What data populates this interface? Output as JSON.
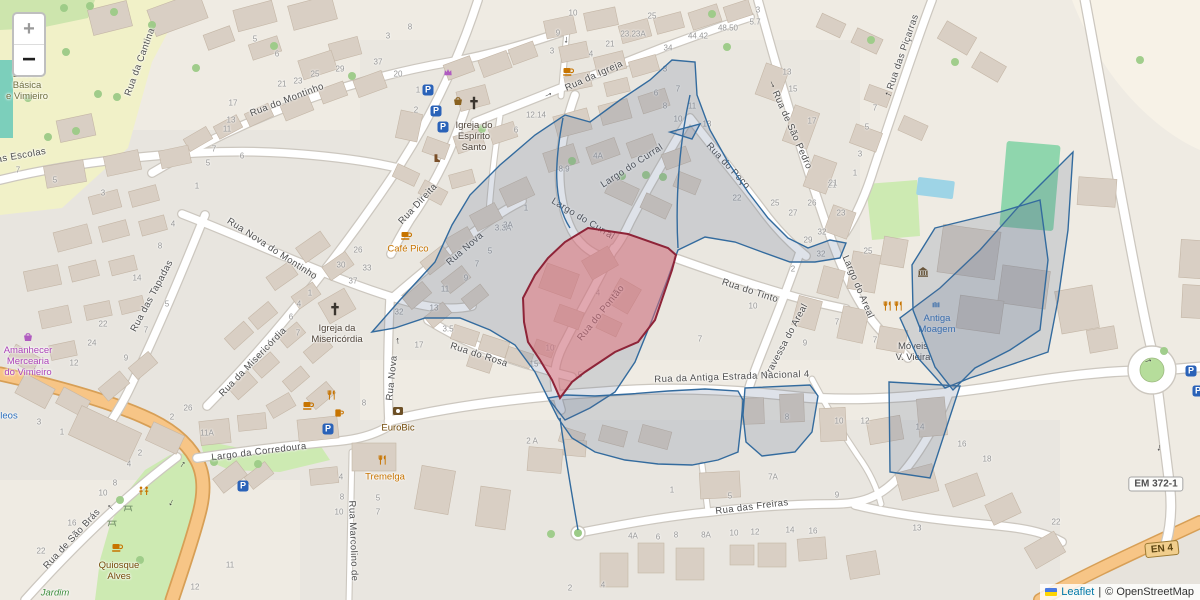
{
  "controls": {
    "zoom_in": "+",
    "zoom_out": "−"
  },
  "attribution": {
    "leaflet": "Leaflet",
    "separator": "|",
    "osm": "© OpenStreetMap"
  },
  "shields": [
    {
      "label": "EM 372-1",
      "x": 1156,
      "y": 484,
      "style": "white",
      "rot": 0
    },
    {
      "label": "EN 4",
      "x": 1162,
      "y": 549,
      "style": "tan",
      "rot": -6
    }
  ],
  "street_labels": [
    [
      140,
      62,
      -70,
      "Rua da Cantina"
    ],
    [
      8,
      158,
      -10,
      "Rua das Escolas"
    ],
    [
      287,
      100,
      -21,
      "Rua do Montinho"
    ],
    [
      272,
      249,
      33,
      "Rua Nova do Montinho"
    ],
    [
      253,
      362,
      -46,
      "Rua da Misericórdia"
    ],
    [
      152,
      296,
      -62,
      "Rua das Tapadas"
    ],
    [
      72,
      539,
      -47,
      "Rua de São Brás"
    ],
    [
      259,
      452,
      -7,
      "Largo da Corredoura"
    ],
    [
      418,
      204,
      -47,
      "Rua Direita"
    ],
    [
      465,
      249,
      -41,
      "Rua Nova"
    ],
    [
      392,
      378,
      -84,
      "Rua Nova"
    ],
    [
      594,
      76,
      -24,
      "Rua da Igreja"
    ],
    [
      632,
      166,
      -33,
      "Largo do Curral"
    ],
    [
      583,
      219,
      31,
      "Largo do Curral"
    ],
    [
      728,
      166,
      47,
      "Rua do Poço"
    ],
    [
      792,
      130,
      66,
      "Rua de São Pedro"
    ],
    [
      903,
      52,
      -71,
      "Rua das Piçarras"
    ],
    [
      858,
      287,
      67,
      "Largo do Areal"
    ],
    [
      786,
      341,
      -62,
      "Travessa do Areal"
    ],
    [
      750,
      291,
      18,
      "Rua do Tinto"
    ],
    [
      601,
      313,
      -51,
      "Rua do Pontão"
    ],
    [
      479,
      355,
      18,
      "Rua do Rosa"
    ],
    [
      732,
      377,
      -2,
      "Rua da Antiga Estrada Nacional 4"
    ],
    [
      752,
      507,
      -7,
      "Rua das Freiras"
    ],
    [
      353,
      541,
      88,
      "Rua Marcolino de"
    ]
  ],
  "poi_labels": [
    {
      "lines": [
        "Escola",
        "Básica",
        "e Vimieiro"
      ],
      "x": 27,
      "y": 86,
      "color": "#6e6e3e",
      "italic": false
    },
    {
      "lines": [
        "Igreja do",
        "Espírito",
        "Santo"
      ],
      "x": 474,
      "y": 137,
      "color": "#4e4338",
      "italic": false
    },
    {
      "lines": [
        "Igreja da",
        "Misericórdia"
      ],
      "x": 337,
      "y": 334,
      "color": "#4e4338",
      "italic": false
    },
    {
      "lines": [
        "Café Pico"
      ],
      "x": 408,
      "y": 249,
      "color": "#c77400",
      "italic": false
    },
    {
      "lines": [
        "EuroBic"
      ],
      "x": 398,
      "y": 428,
      "color": "#734a08",
      "italic": false
    },
    {
      "lines": [
        "Tremelga"
      ],
      "x": 385,
      "y": 477,
      "color": "#c77400",
      "italic": false
    },
    {
      "lines": [
        "Antiga",
        "Moagem"
      ],
      "x": 937,
      "y": 324,
      "color": "#2a6ebb",
      "italic": false
    },
    {
      "lines": [
        "Móveis",
        "V. Vieira"
      ],
      "x": 913,
      "y": 352,
      "color": "#4a4a4a",
      "italic": false
    },
    {
      "lines": [
        "Amanhecer",
        "Mercearia",
        "do Vimieiro"
      ],
      "x": 28,
      "y": 362,
      "color": "#ab44b8",
      "italic": false
    },
    {
      "lines": [
        "Quiosque",
        "Alves"
      ],
      "x": 119,
      "y": 571,
      "color": "#734a08",
      "italic": false
    },
    {
      "lines": [
        "Jardim"
      ],
      "x": 55,
      "y": 593,
      "color": "#3e8e3e",
      "italic": true
    },
    {
      "lines": [
        "leos"
      ],
      "x": 9,
      "y": 416,
      "color": "#2a6ebb",
      "italic": false
    }
  ],
  "house_numbers": [
    [
      573,
      13,
      "10"
    ],
    [
      652,
      16,
      "25"
    ],
    [
      633,
      34,
      "23.23A"
    ],
    [
      610,
      44,
      "21"
    ],
    [
      698,
      36,
      "44.42"
    ],
    [
      728,
      28,
      "48.50"
    ],
    [
      668,
      48,
      "34"
    ],
    [
      755,
      22,
      "5.7"
    ],
    [
      758,
      10,
      "3"
    ],
    [
      558,
      33,
      "9"
    ],
    [
      552,
      51,
      "3"
    ],
    [
      591,
      54,
      "4"
    ],
    [
      398,
      74,
      "20"
    ],
    [
      418,
      90,
      "1"
    ],
    [
      416,
      110,
      "2"
    ],
    [
      536,
      115,
      "12.14"
    ],
    [
      516,
      130,
      "6"
    ],
    [
      598,
      156,
      "4A"
    ],
    [
      564,
      169,
      "8.9"
    ],
    [
      255,
      39,
      "5"
    ],
    [
      277,
      54,
      "6"
    ],
    [
      282,
      84,
      "21"
    ],
    [
      298,
      81,
      "23"
    ],
    [
      315,
      74,
      "25"
    ],
    [
      340,
      69,
      "29"
    ],
    [
      378,
      62,
      "37"
    ],
    [
      410,
      27,
      "8"
    ],
    [
      388,
      36,
      "3"
    ],
    [
      233,
      103,
      "17"
    ],
    [
      231,
      120,
      "13"
    ],
    [
      227,
      129,
      "11"
    ],
    [
      214,
      149,
      "7"
    ],
    [
      242,
      156,
      "6"
    ],
    [
      208,
      163,
      "5"
    ],
    [
      18,
      170,
      "7"
    ],
    [
      55,
      180,
      "5"
    ],
    [
      103,
      193,
      "3"
    ],
    [
      197,
      186,
      "1"
    ],
    [
      173,
      224,
      "4"
    ],
    [
      160,
      246,
      "8"
    ],
    [
      137,
      278,
      "14"
    ],
    [
      167,
      304,
      "5"
    ],
    [
      103,
      324,
      "22"
    ],
    [
      358,
      250,
      "26"
    ],
    [
      341,
      265,
      "30"
    ],
    [
      367,
      268,
      "33"
    ],
    [
      353,
      281,
      "37"
    ],
    [
      310,
      293,
      "1"
    ],
    [
      299,
      304,
      "4"
    ],
    [
      291,
      317,
      "6"
    ],
    [
      298,
      333,
      "7"
    ],
    [
      399,
      312,
      "32"
    ],
    [
      419,
      345,
      "17"
    ],
    [
      503,
      228,
      "3.3A"
    ],
    [
      490,
      251,
      "5"
    ],
    [
      477,
      264,
      "7"
    ],
    [
      466,
      278,
      "9"
    ],
    [
      445,
      289,
      "11"
    ],
    [
      434,
      308,
      "13"
    ],
    [
      448,
      329,
      "3.5"
    ],
    [
      550,
      348,
      "10"
    ],
    [
      534,
      364,
      "15"
    ],
    [
      580,
      375,
      "5"
    ],
    [
      526,
      208,
      "1"
    ],
    [
      508,
      225,
      "3A"
    ],
    [
      737,
      198,
      "22"
    ],
    [
      775,
      203,
      "25"
    ],
    [
      793,
      213,
      "27"
    ],
    [
      793,
      269,
      "2"
    ],
    [
      753,
      306,
      "10"
    ],
    [
      598,
      293,
      "4"
    ],
    [
      700,
      339,
      "7"
    ],
    [
      832,
      185,
      "21"
    ],
    [
      812,
      203,
      "26"
    ],
    [
      841,
      213,
      "23"
    ],
    [
      822,
      232,
      "32"
    ],
    [
      808,
      240,
      "29"
    ],
    [
      821,
      254,
      "32"
    ],
    [
      868,
      251,
      "25"
    ],
    [
      805,
      343,
      "9"
    ],
    [
      837,
      322,
      "7"
    ],
    [
      787,
      72,
      "13"
    ],
    [
      793,
      89,
      "15"
    ],
    [
      812,
      121,
      "17"
    ],
    [
      833,
      183,
      "21"
    ],
    [
      860,
      154,
      "3"
    ],
    [
      855,
      173,
      "1"
    ],
    [
      867,
      127,
      "5"
    ],
    [
      875,
      108,
      "7"
    ],
    [
      665,
      69,
      "3"
    ],
    [
      656,
      93,
      "6"
    ],
    [
      678,
      89,
      "7"
    ],
    [
      665,
      106,
      "8"
    ],
    [
      692,
      106,
      "11"
    ],
    [
      678,
      119,
      "10"
    ],
    [
      707,
      124,
      "13"
    ],
    [
      875,
      340,
      "7"
    ],
    [
      532,
      441,
      "2 A"
    ],
    [
      364,
      403,
      "8"
    ],
    [
      341,
      477,
      "4"
    ],
    [
      342,
      497,
      "8"
    ],
    [
      339,
      512,
      "10"
    ],
    [
      378,
      498,
      "5"
    ],
    [
      378,
      512,
      "7"
    ],
    [
      140,
      453,
      "2"
    ],
    [
      129,
      464,
      "4"
    ],
    [
      115,
      483,
      "8"
    ],
    [
      103,
      493,
      "10"
    ],
    [
      72,
      523,
      "16"
    ],
    [
      41,
      551,
      "22"
    ],
    [
      230,
      565,
      "11"
    ],
    [
      195,
      587,
      "12"
    ],
    [
      672,
      490,
      "1"
    ],
    [
      730,
      496,
      "5"
    ],
    [
      837,
      495,
      "9"
    ],
    [
      633,
      536,
      "4A"
    ],
    [
      658,
      537,
      "6"
    ],
    [
      676,
      535,
      "8"
    ],
    [
      706,
      535,
      "8A"
    ],
    [
      734,
      533,
      "10"
    ],
    [
      755,
      532,
      "12"
    ],
    [
      790,
      530,
      "14"
    ],
    [
      813,
      531,
      "16"
    ],
    [
      570,
      588,
      "2"
    ],
    [
      603,
      585,
      "4"
    ],
    [
      787,
      417,
      "8"
    ],
    [
      839,
      421,
      "10"
    ],
    [
      865,
      421,
      "12"
    ],
    [
      920,
      427,
      "14"
    ],
    [
      962,
      444,
      "16"
    ],
    [
      987,
      459,
      "18"
    ],
    [
      773,
      477,
      "7A"
    ],
    [
      917,
      528,
      "13"
    ],
    [
      1056,
      522,
      "22"
    ],
    [
      92,
      343,
      "24"
    ],
    [
      74,
      363,
      "12"
    ],
    [
      126,
      358,
      "9"
    ],
    [
      146,
      330,
      "7"
    ],
    [
      39,
      422,
      "3"
    ],
    [
      62,
      432,
      "1"
    ],
    [
      172,
      417,
      "2"
    ],
    [
      188,
      408,
      "26"
    ],
    [
      207,
      433,
      "11A"
    ]
  ],
  "parking": {
    "glyph": "P",
    "positions": [
      [
        428,
        90
      ],
      [
        436,
        111
      ],
      [
        443,
        127
      ],
      [
        328,
        429
      ],
      [
        243,
        486
      ],
      [
        1191,
        371
      ],
      [
        1198,
        391
      ]
    ]
  },
  "icons": [
    [
      "church",
      474,
      103
    ],
    [
      "church",
      335,
      309
    ],
    [
      "cafe",
      568,
      71
    ],
    [
      "cafe",
      406,
      235
    ],
    [
      "cafe",
      308,
      405
    ],
    [
      "cafe",
      117,
      547
    ],
    [
      "restaurant",
      332,
      395
    ],
    [
      "restaurant",
      383,
      460
    ],
    [
      "restaurant",
      888,
      306
    ],
    [
      "restaurant",
      899,
      306
    ],
    [
      "bar",
      339,
      413
    ],
    [
      "museum",
      923,
      272
    ],
    [
      "bank",
      398,
      411
    ],
    [
      "shop",
      28,
      337
    ],
    [
      "crown",
      448,
      72
    ],
    [
      "basket",
      458,
      101
    ],
    [
      "boot",
      437,
      158
    ],
    [
      "mill",
      936,
      305
    ],
    [
      "playground",
      144,
      491
    ],
    [
      "picnic",
      128,
      508
    ],
    [
      "picnic",
      112,
      523
    ]
  ],
  "icon_colors": {
    "church": "#3a352f",
    "cafe": "#c77400",
    "restaurant": "#c77400",
    "bar": "#c77400",
    "museum": "#6d5026",
    "bank": "#6d5026",
    "shop": "#b05bc0",
    "crown": "#b05bc0",
    "basket": "#8a6220",
    "boot": "#7a4f28",
    "mill": "#2a6ebb",
    "playground": "#c77400",
    "picnic": "#7c9970"
  },
  "oneway": {
    "glyph": "→",
    "positions": [
      [
        548,
        94,
        -25
      ],
      [
        567,
        40,
        95
      ],
      [
        397,
        341,
        -95
      ],
      [
        773,
        84,
        65
      ],
      [
        888,
        95,
        205
      ],
      [
        110,
        508,
        -135
      ],
      [
        182,
        464,
        -55
      ],
      [
        172,
        503,
        115
      ],
      [
        1148,
        360,
        -15
      ],
      [
        1160,
        448,
        100
      ]
    ]
  },
  "overlays": {
    "blue_stroke": "#336b9e",
    "blue_fill": "rgba(90,110,145,0.20)",
    "blue_polys": [
      "372,332 400,300 435,262 452,225 470,195 500,165 535,135 565,115 590,122 620,100 650,80 672,60 695,62 697,95 710,130 728,162 748,192 768,218 788,238 808,248 830,240 846,243 840,258 815,262 790,262 762,252 735,242 705,237 678,250 668,278 652,320 635,362 615,392 590,408 565,420 548,398 535,372 515,345 490,330 460,318 425,318 395,328",
      "548,398 558,418 572,438 595,452 625,460 658,464 692,465 718,460 738,452 741,425 743,400 738,391 705,389 668,391 630,394 595,396 566,395",
      "745,388 810,385 818,396 812,432 795,452 762,456 746,442 743,415",
      "889,382 960,386 930,478 890,472",
      "1073,152 1068,230 1058,300 1048,352 1010,365 970,378 945,388 918,358 900,318 940,288 980,250 1020,205 1050,175",
      "935,228 1000,212 1040,200 1048,260 1040,330 1010,350 975,368 953,390 935,367 913,310 912,265",
      "670,132 700,124 692,139"
    ],
    "blue_lines": [
      "M563,118 C555,160 552,200 570,228",
      "M690,95 C680,140 675,195 678,248",
      "M560,418 C565,455 572,495 578,530"
    ],
    "red": {
      "stroke": "#8e2438",
      "fill": "rgba(228,110,120,0.5)",
      "points": "588,228 628,234 668,248 676,255 672,270 655,320 638,342 615,352 600,362 585,372 572,382 560,398 552,380 540,360 528,342 524,322 523,298 535,275 548,258 565,242"
    }
  }
}
